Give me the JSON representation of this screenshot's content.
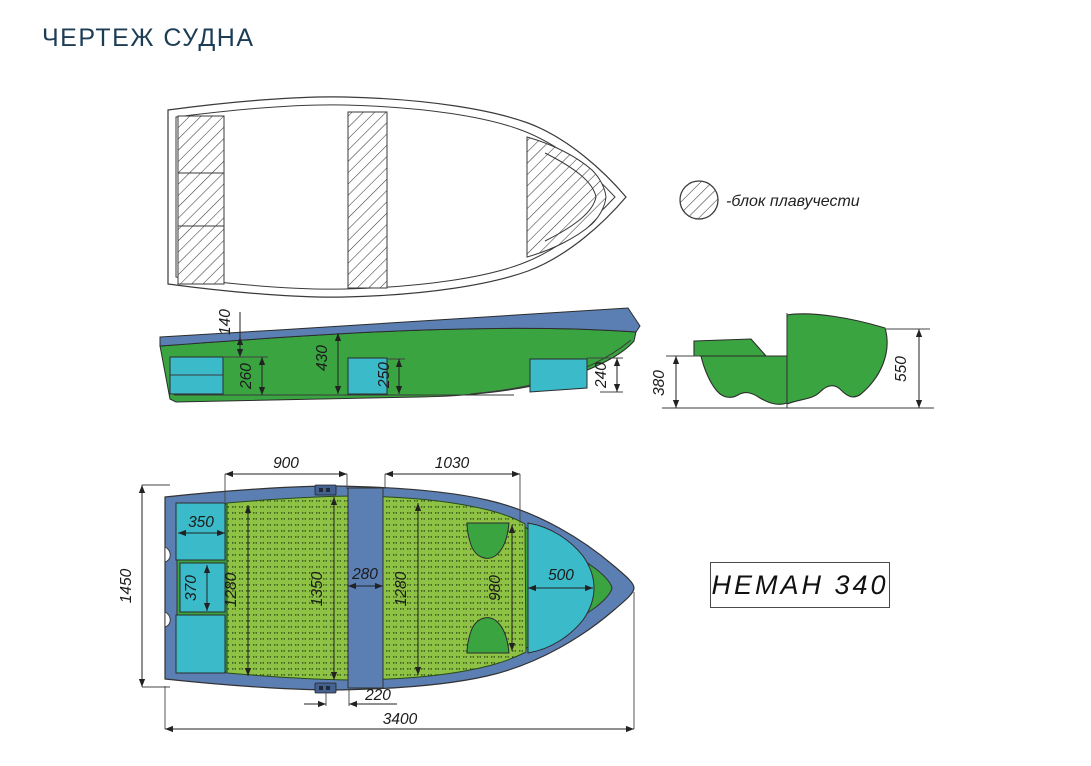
{
  "page": {
    "title": "ЧЕРТЕЖ СУДНА"
  },
  "legend": {
    "label": "-блок плавучести",
    "symbol": "hatched-circle"
  },
  "model_plate": {
    "text": "НЕМАН 340"
  },
  "colors": {
    "title_text": "#1d3d55",
    "hull_green": "#3aa441",
    "floor_green": "#8ec244",
    "floor_dots": "#2f4d1c",
    "seat_cyan": "#3bbac9",
    "gunwale_blue": "#5b7fb2",
    "drawing_line": "#3a3a3a"
  },
  "side_view": {
    "dims": {
      "gunwale_height": "140",
      "stern_seat_height": "260",
      "cockpit_depth": "430",
      "middle_seat_height": "250",
      "bow_seat_height": "240"
    }
  },
  "section_view": {
    "dims": {
      "stern_half_height": "380",
      "bow_half_height": "550"
    }
  },
  "plan_view": {
    "dims": {
      "fore_floor_span": "900",
      "aft_floor_span": "1030",
      "stern_seat_width": "350",
      "stern_seat_mid_height": "370",
      "floor_left_height": "1280",
      "cockpit_inner_height": "1350",
      "thwart_width": "280",
      "floor_right_height": "1280",
      "bow_floor_height": "980",
      "bow_seat_width": "500",
      "overall_beam": "1450",
      "thwart_offset": "220",
      "overall_length": "3400"
    }
  }
}
